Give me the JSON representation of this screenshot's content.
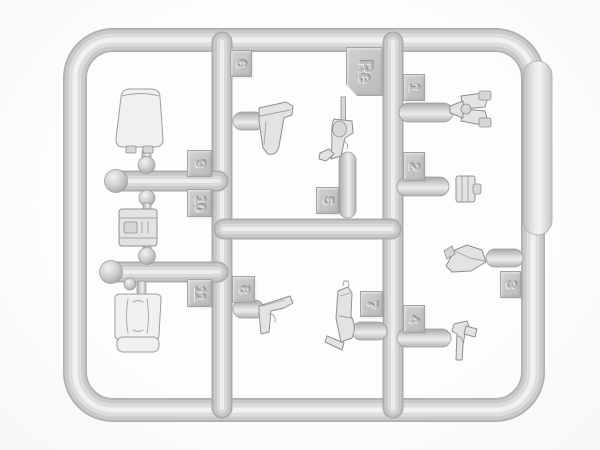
{
  "scene": {
    "subject": "plastic-model-kit-sprue",
    "material_color": "light-gray"
  },
  "colors": {
    "background": "#fdfdfd",
    "sprue_edge": "#aeafb1",
    "sprue_mid": "#c9cacc",
    "sprue_highlight": "#f0f1f2",
    "tag_fill": "#c3c4c6",
    "tag_border": "#a3a4a6",
    "part_fill": "#e2e3e5",
    "part_outline": "#8e8f91"
  },
  "tags": [
    {
      "id": "tag-6",
      "label": "6"
    },
    {
      "id": "tag-re",
      "label": "Re"
    },
    {
      "id": "tag-1",
      "label": "1"
    },
    {
      "id": "tag-2",
      "label": "2"
    },
    {
      "id": "tag-9",
      "label": "9"
    },
    {
      "id": "tag-10",
      "label": "10"
    },
    {
      "id": "tag-11",
      "label": "11"
    },
    {
      "id": "tag-5",
      "label": "5"
    },
    {
      "id": "tag-8",
      "label": "8"
    },
    {
      "id": "tag-7",
      "label": "7"
    },
    {
      "id": "tag-4",
      "label": "4"
    },
    {
      "id": "tag-3",
      "label": "3"
    }
  ],
  "parts": [
    {
      "name": "seat-backrest"
    },
    {
      "name": "equipment-box"
    },
    {
      "name": "seat-cushion"
    },
    {
      "name": "holster-upper"
    },
    {
      "name": "revolver"
    },
    {
      "name": "binoculars"
    },
    {
      "name": "ammo-pouch"
    },
    {
      "name": "holster-flap"
    },
    {
      "name": "pistol"
    },
    {
      "name": "holster-with-strap"
    },
    {
      "name": "pistol-muzzle-down"
    }
  ]
}
